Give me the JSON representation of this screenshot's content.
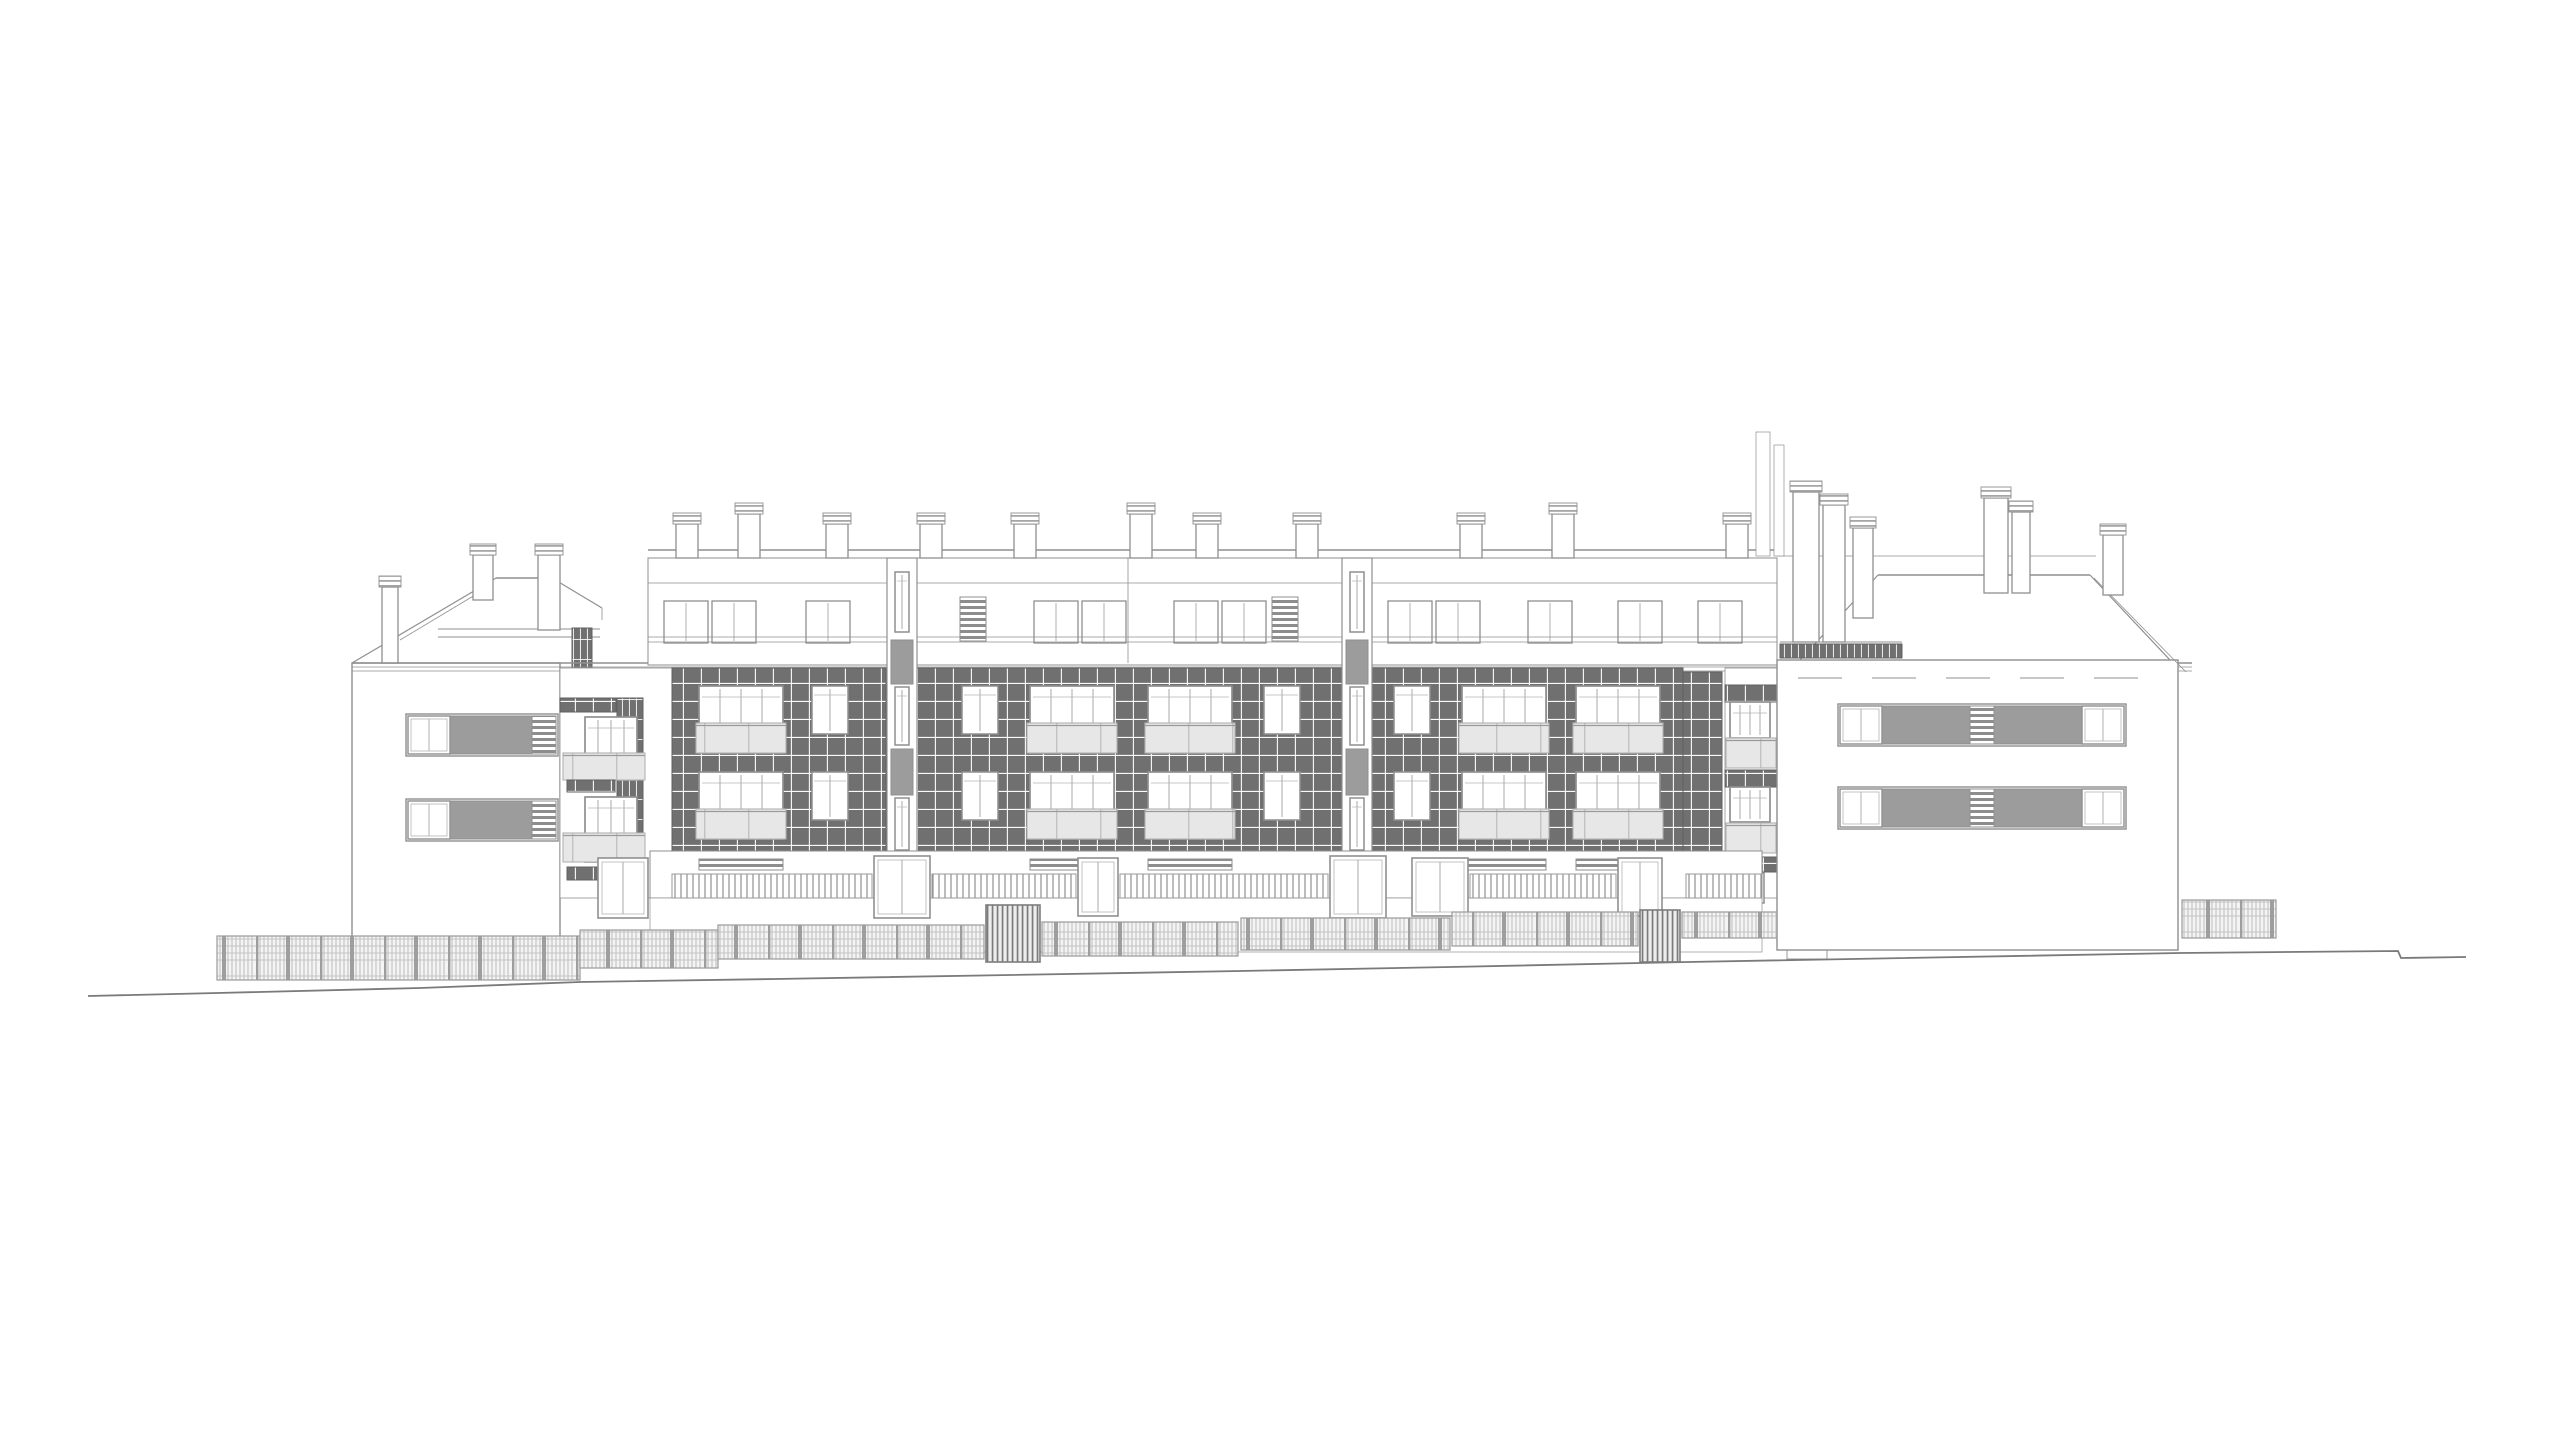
{
  "title": "Residential building street elevation drawing",
  "canvas": {
    "w": 2560,
    "h": 1440,
    "background": "#ffffff"
  },
  "colors": {
    "line": "#8f8f8f",
    "line_soft": "#b5b5b5",
    "line_dark": "#6e6e6e",
    "tile": "#707070",
    "tile_joint": "#fafafa",
    "panel": "#9c9c9c",
    "glass": "#e7e7e7",
    "glass_frame": "#b2b2b2",
    "fence_line": "#b0b0b0",
    "fence_frame": "#9a9a9a",
    "gate_frame": "#7d7d7d",
    "ground": "#7a7a7a",
    "white": "#ffffff"
  },
  "elements": [
    [
      "rect",
      "left-wing-wall",
      352,
      663,
      208,
      277,
      "#ffffff",
      1.4
    ],
    [
      "line",
      "left-roof-slope-outer",
      352,
      663,
      496,
      578,
      1.2
    ],
    [
      "line",
      "left-roof-slope-inner",
      400,
      640,
      490,
      586,
      0.8
    ],
    [
      "line",
      "left-roof-ridge",
      496,
      578,
      552,
      578,
      1.6
    ],
    [
      "line",
      "left-roof-slope-right",
      552,
      578,
      602,
      608,
      1.2
    ],
    [
      "line",
      "left-roof-step",
      602,
      608,
      602,
      620,
      0.8
    ],
    [
      "line",
      "left-roof-deck-upper",
      438,
      629,
      600,
      629,
      0.9
    ],
    [
      "line",
      "left-roof-deck-lower",
      438,
      637,
      600,
      637,
      0.9
    ],
    [
      "vtiles",
      "roof-access-ladder",
      572,
      628,
      20,
      40
    ],
    [
      "chimney",
      "chimney",
      382,
      587,
      16,
      76
    ],
    [
      "chimney",
      "chimney",
      473,
      555,
      20,
      45
    ],
    [
      "chimney",
      "chimney",
      538,
      555,
      22,
      75
    ],
    [
      "line",
      "main-eave-line-1",
      352,
      663,
      2192,
      663,
      1.6
    ],
    [
      "line",
      "main-eave-line-2",
      352,
      667,
      2192,
      667,
      0.8
    ],
    [
      "line",
      "main-eave-line-3",
      352,
      671,
      2192,
      671,
      0.8
    ],
    [
      "rect",
      "window-band-frame",
      406,
      714,
      152,
      42,
      "none",
      1.4
    ],
    [
      "winband",
      "band-window",
      408,
      716,
      42,
      38
    ],
    [
      "panel",
      "band-panel",
      450,
      716,
      82,
      38
    ],
    [
      "louver",
      "band-louver",
      532,
      716,
      24,
      38
    ],
    [
      "rect",
      "window-band-frame",
      406,
      799,
      152,
      42,
      "none",
      1.4
    ],
    [
      "winband",
      "band-window",
      408,
      801,
      42,
      38
    ],
    [
      "panel",
      "band-panel",
      450,
      801,
      82,
      38
    ],
    [
      "louver",
      "band-louver",
      532,
      801,
      24,
      38
    ],
    [
      "rect",
      "balcony-recess",
      560,
      668,
      112,
      230,
      "#ffffff",
      0.8
    ],
    [
      "tiles",
      "balcony-tile-band",
      560,
      698,
      56,
      14
    ],
    [
      "vtiles",
      "balcony-pier",
      617,
      698,
      26,
      182
    ],
    [
      "rect",
      "pier-slab-gap",
      615,
      755,
      30,
      5,
      "#ffffff",
      0
    ],
    [
      "rect",
      "pier-slab-gap",
      615,
      838,
      30,
      5,
      "#ffffff",
      0
    ],
    [
      "winb",
      "balcony-window",
      585,
      717,
      52,
      63
    ],
    [
      "glass",
      "balcony-railing",
      563,
      753,
      82,
      27
    ],
    [
      "tiles",
      "balcony-tile-band",
      567,
      780,
      48,
      12
    ],
    [
      "winb",
      "balcony-window",
      585,
      797,
      52,
      65
    ],
    [
      "glass",
      "balcony-railing",
      563,
      833,
      82,
      29
    ],
    [
      "tiles",
      "balcony-tile-band",
      567,
      867,
      48,
      13
    ],
    [
      "door",
      "terrace-door",
      598,
      858,
      50,
      60
    ],
    [
      "line",
      "parapet-top-line",
      648,
      550,
      1777,
      550,
      1.4
    ],
    [
      "rect",
      "attic-wall",
      648,
      558,
      1129,
      107,
      "#ffffff",
      1.0
    ],
    [
      "line",
      "attic-band-line",
      648,
      583,
      1777,
      583,
      0.8
    ],
    [
      "line",
      "party-wall-line",
      1128,
      558,
      1128,
      663,
      0.8
    ],
    [
      "chimney",
      "chimney",
      676,
      524,
      22,
      34
    ],
    [
      "chimney",
      "chimney",
      738,
      514,
      22,
      44
    ],
    [
      "chimney",
      "chimney",
      826,
      524,
      22,
      34
    ],
    [
      "chimney",
      "chimney",
      920,
      524,
      22,
      34
    ],
    [
      "chimney",
      "chimney",
      1014,
      524,
      22,
      34
    ],
    [
      "chimney",
      "chimney",
      1130,
      514,
      22,
      44
    ],
    [
      "chimney",
      "chimney",
      1196,
      524,
      22,
      34
    ],
    [
      "chimney",
      "chimney",
      1296,
      524,
      22,
      34
    ],
    [
      "chimney",
      "chimney",
      1460,
      524,
      22,
      34
    ],
    [
      "chimney",
      "chimney",
      1552,
      514,
      22,
      44
    ],
    [
      "chimney",
      "chimney",
      1726,
      524,
      22,
      34
    ],
    [
      "wina",
      "attic-window",
      664,
      601,
      44,
      42
    ],
    [
      "wina",
      "attic-window",
      712,
      601,
      44,
      42
    ],
    [
      "wina",
      "attic-window",
      806,
      601,
      44,
      42
    ],
    [
      "louver",
      "attic-louver",
      960,
      597,
      26,
      44
    ],
    [
      "wina",
      "attic-window",
      1034,
      601,
      44,
      42
    ],
    [
      "wina",
      "attic-window",
      1082,
      601,
      44,
      42
    ],
    [
      "wina",
      "attic-window",
      1174,
      601,
      44,
      42
    ],
    [
      "wina",
      "attic-window",
      1222,
      601,
      44,
      42
    ],
    [
      "louver",
      "attic-louver",
      1272,
      597,
      26,
      44
    ],
    [
      "wina",
      "attic-window",
      1388,
      601,
      44,
      42
    ],
    [
      "wina",
      "attic-window",
      1436,
      601,
      44,
      42
    ],
    [
      "wina",
      "attic-window",
      1528,
      601,
      44,
      42
    ],
    [
      "wina",
      "attic-window",
      1618,
      601,
      44,
      42
    ],
    [
      "wina",
      "attic-window",
      1698,
      601,
      44,
      42
    ],
    [
      "line",
      "attic-railing-1",
      648,
      637,
      1777,
      637,
      0.8
    ],
    [
      "line",
      "attic-railing-2",
      648,
      642,
      1777,
      642,
      0.8
    ],
    [
      "tiles",
      "tile-facade",
      672,
      668,
      214,
      183
    ],
    [
      "tiles",
      "tile-facade",
      917,
      668,
      425,
      183
    ],
    [
      "tiles",
      "tile-facade",
      1372,
      668,
      311,
      183
    ],
    [
      "tiles",
      "corner-pier",
      1683,
      672,
      39,
      185
    ],
    [
      "rect",
      "stair-strip",
      887,
      558,
      30,
      294,
      "#ffffff",
      1.2
    ],
    [
      "wins",
      "stair-window",
      895,
      572,
      14,
      60
    ],
    [
      "panel",
      "stair-panel",
      891,
      640,
      22,
      44
    ],
    [
      "wins",
      "stair-window",
      895,
      687,
      14,
      58
    ],
    [
      "panel",
      "stair-panel",
      891,
      749,
      22,
      46
    ],
    [
      "wins",
      "stair-window",
      895,
      798,
      14,
      52
    ],
    [
      "rect",
      "stair-strip",
      1342,
      558,
      30,
      294,
      "#ffffff",
      1.2
    ],
    [
      "wins",
      "stair-window",
      1350,
      572,
      14,
      60
    ],
    [
      "panel",
      "stair-panel",
      1346,
      640,
      22,
      44
    ],
    [
      "wins",
      "stair-window",
      1350,
      687,
      14,
      58
    ],
    [
      "panel",
      "stair-panel",
      1346,
      749,
      22,
      46
    ],
    [
      "wins",
      "stair-window",
      1350,
      798,
      14,
      52
    ],
    [
      "winb",
      "apartment-window",
      699,
      686,
      84,
      67
    ],
    [
      "glass",
      "balcony-railing",
      696,
      723,
      90,
      30
    ],
    [
      "winb",
      "apartment-window",
      699,
      772,
      84,
      67
    ],
    [
      "glass",
      "balcony-railing",
      696,
      809,
      90,
      30
    ],
    [
      "wins",
      "apartment-window-small",
      812,
      686,
      36,
      48
    ],
    [
      "wins",
      "apartment-window-small",
      812,
      772,
      36,
      48
    ],
    [
      "wins",
      "apartment-window-small",
      962,
      686,
      36,
      48
    ],
    [
      "wins",
      "apartment-window-small",
      962,
      772,
      36,
      48
    ],
    [
      "winb",
      "apartment-window",
      1030,
      686,
      84,
      67
    ],
    [
      "glass",
      "balcony-railing",
      1027,
      723,
      90,
      30
    ],
    [
      "winb",
      "apartment-window",
      1030,
      772,
      84,
      67
    ],
    [
      "glass",
      "balcony-railing",
      1027,
      809,
      90,
      30
    ],
    [
      "winb",
      "apartment-window",
      1148,
      686,
      84,
      67
    ],
    [
      "glass",
      "balcony-railing",
      1145,
      723,
      90,
      30
    ],
    [
      "winb",
      "apartment-window",
      1148,
      772,
      84,
      67
    ],
    [
      "glass",
      "balcony-railing",
      1145,
      809,
      90,
      30
    ],
    [
      "wins",
      "apartment-window-small",
      1264,
      686,
      36,
      48
    ],
    [
      "wins",
      "apartment-window-small",
      1264,
      772,
      36,
      48
    ],
    [
      "wins",
      "apartment-window-small",
      1394,
      686,
      36,
      48
    ],
    [
      "wins",
      "apartment-window-small",
      1394,
      772,
      36,
      48
    ],
    [
      "winb",
      "apartment-window",
      1462,
      686,
      84,
      67
    ],
    [
      "glass",
      "balcony-railing",
      1459,
      723,
      90,
      30
    ],
    [
      "winb",
      "apartment-window",
      1462,
      772,
      84,
      67
    ],
    [
      "glass",
      "balcony-railing",
      1459,
      809,
      90,
      30
    ],
    [
      "winb",
      "apartment-window",
      1576,
      686,
      84,
      67
    ],
    [
      "glass",
      "balcony-railing",
      1573,
      723,
      90,
      30
    ],
    [
      "winb",
      "apartment-window",
      1576,
      772,
      84,
      67
    ],
    [
      "glass",
      "balcony-railing",
      1573,
      809,
      90,
      30
    ],
    [
      "rect",
      "corner-recess",
      1725,
      668,
      52,
      230,
      "#ffffff",
      0.8
    ],
    [
      "tiles",
      "corner-tile-band",
      1725,
      685,
      52,
      17
    ],
    [
      "winb",
      "corner-window",
      1730,
      702,
      40,
      36
    ],
    [
      "glass",
      "corner-glazing",
      1726,
      738,
      50,
      30
    ],
    [
      "tiles",
      "corner-tile-band",
      1725,
      770,
      52,
      17
    ],
    [
      "winb",
      "corner-window",
      1730,
      787,
      40,
      35
    ],
    [
      "glass",
      "corner-glazing",
      1726,
      823,
      50,
      30
    ],
    [
      "tiles",
      "corner-tile-band",
      1725,
      857,
      52,
      15
    ],
    [
      "wins",
      "corner-ground-window",
      1735,
      873,
      12,
      30
    ],
    [
      "wins",
      "corner-ground-window",
      1752,
      873,
      12,
      30
    ],
    [
      "rect",
      "ground-floor",
      650,
      851,
      1112,
      47,
      "#ffffff",
      1.0
    ],
    [
      "rect",
      "ground-floor-apron",
      650,
      898,
      1112,
      54,
      "#ffffff",
      0.7
    ],
    [
      "louver",
      "planter-box",
      699,
      859,
      84,
      11
    ],
    [
      "louver",
      "planter-box",
      1030,
      859,
      84,
      11
    ],
    [
      "louver",
      "planter-box",
      1148,
      859,
      84,
      11
    ],
    [
      "louver",
      "planter-box",
      1462,
      859,
      84,
      11
    ],
    [
      "louver",
      "planter-box",
      1576,
      859,
      84,
      11
    ],
    [
      "slats",
      "terrace-railing",
      672,
      874,
      200,
      24
    ],
    [
      "slats",
      "terrace-railing",
      932,
      874,
      144,
      24
    ],
    [
      "slats",
      "terrace-railing",
      1120,
      874,
      208,
      24
    ],
    [
      "slats",
      "terrace-railing",
      1470,
      874,
      146,
      24
    ],
    [
      "slats",
      "terrace-railing",
      1686,
      874,
      76,
      24
    ],
    [
      "door",
      "entrance-door",
      874,
      856,
      56,
      62
    ],
    [
      "door",
      "entrance-door",
      1330,
      856,
      56,
      62
    ],
    [
      "door",
      "terrace-door",
      1078,
      858,
      40,
      58
    ],
    [
      "door",
      "terrace-door",
      1412,
      858,
      56,
      58
    ],
    [
      "door",
      "terrace-door",
      1618,
      858,
      44,
      58
    ],
    [
      "rect",
      "right-wing-wall",
      1777,
      660,
      401,
      290,
      "#ffffff",
      1.4
    ],
    [
      "line",
      "right-roof-back-line",
      1777,
      556,
      2096,
      556,
      0.8
    ],
    [
      "line",
      "right-roof-ridge",
      1878,
      575,
      2090,
      575,
      1.6
    ],
    [
      "line",
      "right-roof-hip-left",
      1878,
      575,
      1800,
      660,
      1.2
    ],
    [
      "line",
      "right-roof-hip-right",
      2090,
      575,
      2170,
      660,
      1.2
    ],
    [
      "line",
      "right-roof-diagonal",
      2094,
      578,
      2186,
      672,
      0.8
    ],
    [
      "line",
      "right-deck-railing",
      1780,
      642,
      1902,
      642,
      0.9
    ],
    [
      "vtiles",
      "right-deck-railing-posts",
      1780,
      644,
      122,
      14
    ],
    [
      "rect",
      "vent-stack",
      1756,
      432,
      14,
      124,
      "#ffffff",
      0.7
    ],
    [
      "rect",
      "vent-stack",
      1774,
      445,
      10,
      111,
      "#ffffff",
      0.7
    ],
    [
      "chimney",
      "chimney",
      1793,
      492,
      26,
      150
    ],
    [
      "chimney",
      "chimney",
      1823,
      505,
      22,
      137
    ],
    [
      "chimney",
      "chimney",
      1853,
      528,
      20,
      90
    ],
    [
      "chimney",
      "chimney",
      1984,
      498,
      24,
      95
    ],
    [
      "chimney",
      "chimney",
      2012,
      512,
      18,
      81
    ],
    [
      "chimney",
      "chimney",
      2103,
      535,
      20,
      60
    ],
    [
      "dash",
      "right-facade-dashed-line",
      1798,
      678,
      2168,
      678
    ],
    [
      "rect",
      "window-band-frame",
      1838,
      704,
      288,
      42,
      "none",
      1.4
    ],
    [
      "winband",
      "band-window",
      1840,
      706,
      42,
      38
    ],
    [
      "panel",
      "band-panel",
      1882,
      706,
      88,
      38
    ],
    [
      "louver",
      "band-louver",
      1970,
      706,
      24,
      38
    ],
    [
      "panel",
      "band-panel",
      1994,
      706,
      88,
      38
    ],
    [
      "winband",
      "band-window",
      2082,
      706,
      42,
      38
    ],
    [
      "rect",
      "window-band-frame",
      1838,
      787,
      288,
      42,
      "none",
      1.4
    ],
    [
      "winband",
      "band-window",
      1840,
      789,
      42,
      38
    ],
    [
      "panel",
      "band-panel",
      1882,
      789,
      88,
      38
    ],
    [
      "louver",
      "band-louver",
      1970,
      789,
      24,
      38
    ],
    [
      "panel",
      "band-panel",
      1994,
      789,
      88,
      38
    ],
    [
      "winband",
      "band-window",
      2082,
      789,
      42,
      38
    ],
    [
      "rect",
      "wall-vent",
      1787,
      950,
      40,
      9,
      "none",
      0.9
    ],
    [
      "fence",
      "site-fence",
      217,
      936,
      363,
      44
    ],
    [
      "fence",
      "site-fence",
      580,
      930,
      138,
      38
    ],
    [
      "fence",
      "site-fence",
      718,
      925,
      266,
      34
    ],
    [
      "gate",
      "site-gate",
      986,
      905,
      54,
      57
    ],
    [
      "fence",
      "site-fence",
      1042,
      922,
      196,
      34
    ],
    [
      "fence",
      "site-fence",
      1241,
      918,
      209,
      32
    ],
    [
      "fence",
      "site-fence",
      1452,
      912,
      186,
      34
    ],
    [
      "gate",
      "site-gate",
      1640,
      910,
      40,
      52
    ],
    [
      "fence",
      "site-fence",
      1682,
      912,
      95,
      26
    ],
    [
      "fence",
      "site-fence",
      2182,
      900,
      94,
      38
    ],
    [
      "poly",
      "ground-line",
      "88,996 217,993 420,988 580,982 775,979 1010,975 1240,971 1450,967 1688,962 2180,953 2398,951 2401,958 2466,957",
      1.8
    ]
  ]
}
